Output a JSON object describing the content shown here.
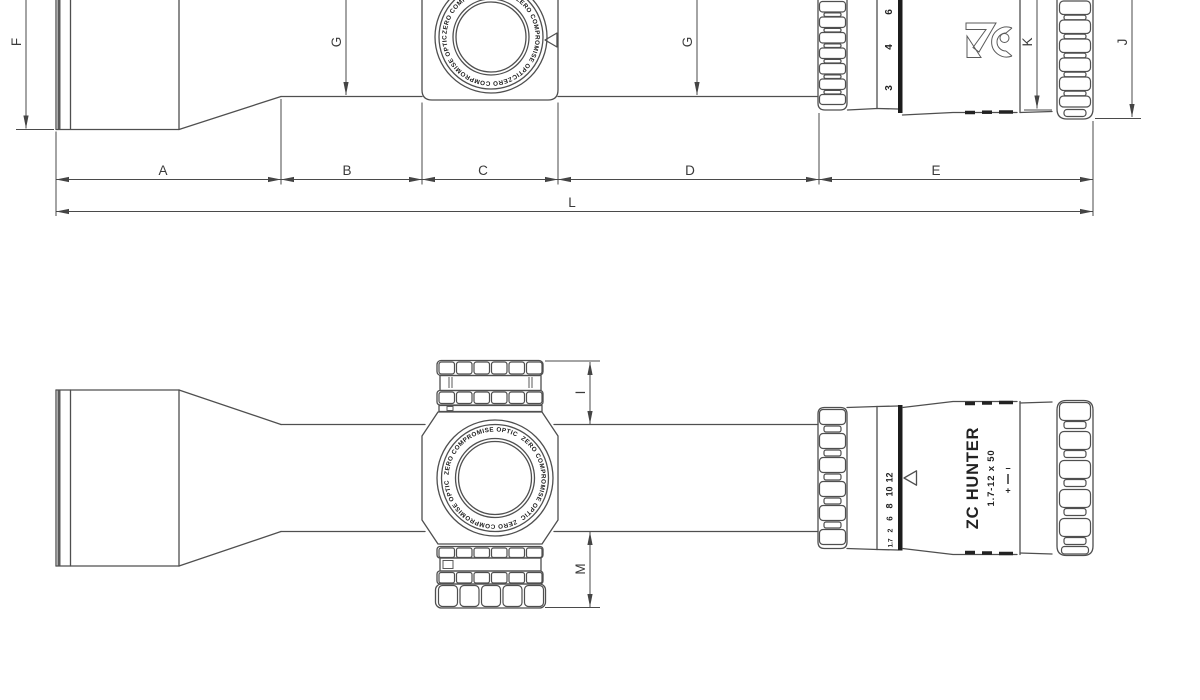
{
  "dimension_labels": {
    "a": "A",
    "b": "B",
    "c": "C",
    "d": "D",
    "e": "E",
    "f": "F",
    "g1": "G",
    "g2": "G",
    "i": "I",
    "j": "J",
    "k": "K",
    "l": "L",
    "m": "M"
  },
  "turret": {
    "cap_text": "ZERO COMPROMISE OPTIC"
  },
  "eyepiece": {
    "model": "ZC HUNTER",
    "spec": "1.7-12 x 50",
    "diopter_plus": "+",
    "diopter_minus": "−",
    "mag_side": [
      "6",
      "4",
      "3"
    ],
    "mag_plan": [
      "12",
      "10",
      "8",
      "6",
      "2",
      "1.7"
    ]
  },
  "colors": {
    "line": "#4f4f4f",
    "dark": "#1c1c1c",
    "background": "#ffffff"
  }
}
